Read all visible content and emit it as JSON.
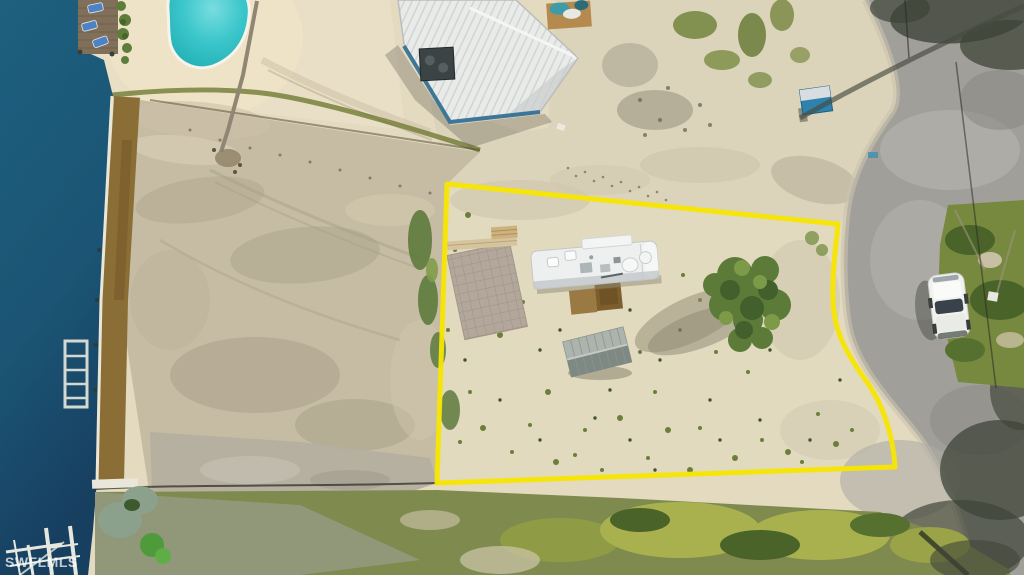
{
  "watermark": {
    "text": "SWFLMLS"
  },
  "photo": {
    "kind": "aerial-drone-photo",
    "subject": "Vacant waterfront lot outlined in yellow containing an RV trailer, gray canopy tent and paver patio; canal water with docks and a boat lift on the left, kidney-shaped swimming pool and white metal-roof building at top, curving asphalt road with a parked white car and green median island on the right, storm-damaged vegetation along the bottom",
    "annotations": {
      "lot_boundary_shape": "polygon",
      "lot_boundary_color": "#F7E600"
    }
  },
  "scene": {
    "objects": [
      "canal-water",
      "seawall",
      "seagrass-strip",
      "sun-deck",
      "lounge-chairs",
      "swimming-pool",
      "fallen-palm",
      "metal-roof-building",
      "ac-unit",
      "boat-on-pallet",
      "porta-potty",
      "left-dirt-lot",
      "property-boundary",
      "rv-trailer",
      "entry-mats",
      "paver-patio",
      "wood-planks",
      "canopy-tent",
      "bush-cluster",
      "asphalt-road",
      "green-median-island",
      "white-car",
      "power-line",
      "pole-shadow",
      "tree-shadows",
      "bottom-vegetation",
      "boat-lift",
      "bottom-docks",
      "agave-cluster"
    ],
    "colors": {
      "water": "#1B5878",
      "pool": "#3AC6CA",
      "beach_sand": "#E9DFC6",
      "lot_sand": "#E2DABF",
      "dirt": "#C6BCA4",
      "road": "#A09F99",
      "vegetation": "#75863F",
      "seagrass": "#8A6E35",
      "boundary": "#F7E600",
      "roof": "#E9EBE9",
      "building_wall": "#2E6D92",
      "car": "#F1F2EF"
    }
  }
}
